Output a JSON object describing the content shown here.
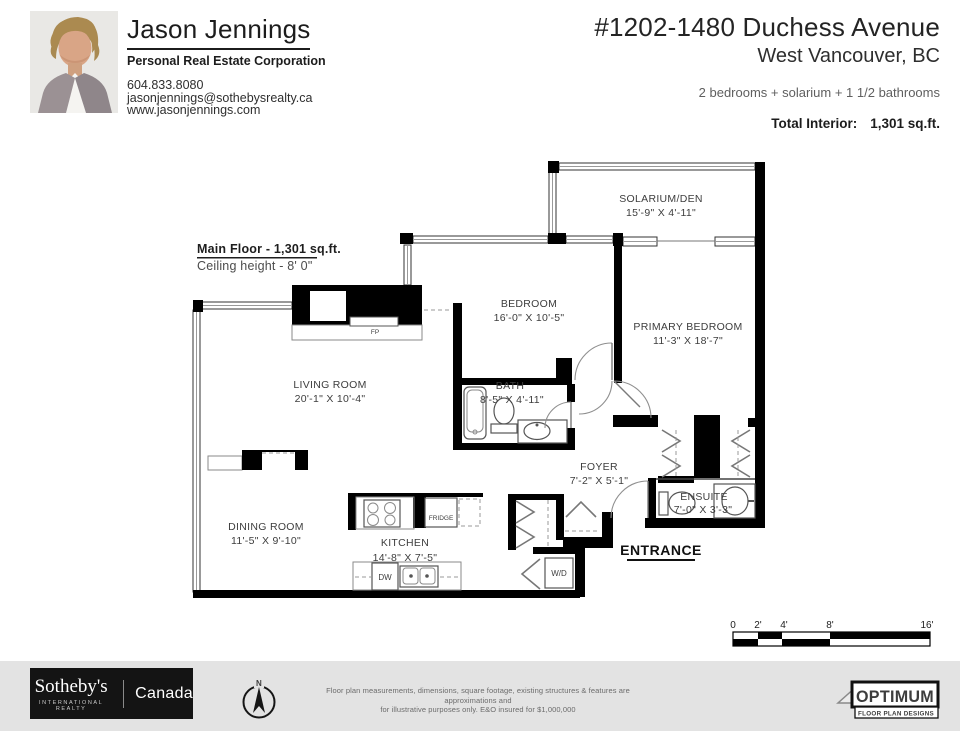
{
  "header": {
    "agent": {
      "name": "Jason Jennings",
      "title": "Personal Real Estate Corporation",
      "phone": "604.833.8080",
      "email": "jasonjennings@sothebysrealty.ca",
      "website": "www.jasonjennings.com"
    },
    "listing": {
      "address": "#1202-1480 Duchess Avenue",
      "city": "West Vancouver, BC",
      "summary": "2 bedrooms + solarium + 1 1/2 bathrooms",
      "total_label": "Total Interior:",
      "total_value": "1,301 sq.ft."
    }
  },
  "plan": {
    "floor_label": "Main Floor - 1,301 sq.ft.",
    "ceiling": "Ceiling height - 8' 0\"",
    "entrance_label": "ENTRANCE",
    "rooms": [
      {
        "name": "SOLARIUM/DEN",
        "dims": "15'-9\" X 4'-11\""
      },
      {
        "name": "BEDROOM",
        "dims": "16'-0\" X 10'-5\""
      },
      {
        "name": "PRIMARY BEDROOM",
        "dims": "11'-3\" X 18'-7\""
      },
      {
        "name": "LIVING ROOM",
        "dims": "20'-1\" X 10'-4\""
      },
      {
        "name": "BATH",
        "dims": "8'-5\" X 4'-11\""
      },
      {
        "name": "FOYER",
        "dims": "7'-2\" X 5'-1\""
      },
      {
        "name": "ENSUITE",
        "dims": "7'-0\" X 3'-3\""
      },
      {
        "name": "DINING ROOM",
        "dims": "11'-5\" X 9'-10\""
      },
      {
        "name": "KITCHEN",
        "dims": "14'-8\" X 7'-5\""
      }
    ],
    "fixtures": {
      "fp": "FP",
      "fridge": "FRIDGE",
      "dw": "DW",
      "wd": "W/D"
    },
    "scale_bar": {
      "labels": [
        "0",
        "2'",
        "4'",
        "8'",
        "16'"
      ]
    }
  },
  "footer": {
    "sothebys": {
      "brand": "Sotheby's",
      "sub": "INTERNATIONAL REALTY",
      "country": "Canada"
    },
    "compass_n": "N",
    "disclaimer_line1": "Floor plan measurements, dimensions, square footage, existing structures & features are approximations and",
    "disclaimer_line2": "for illustrative purposes only.  E&O insured for $1,000,000",
    "optimum": {
      "name": "OPTIMUM",
      "sub": "FLOOR PLAN DESIGNS"
    }
  },
  "colors": {
    "wall": "#000000",
    "footer_bg": "#e3e3e3",
    "label_text": "#3d3d3d"
  }
}
